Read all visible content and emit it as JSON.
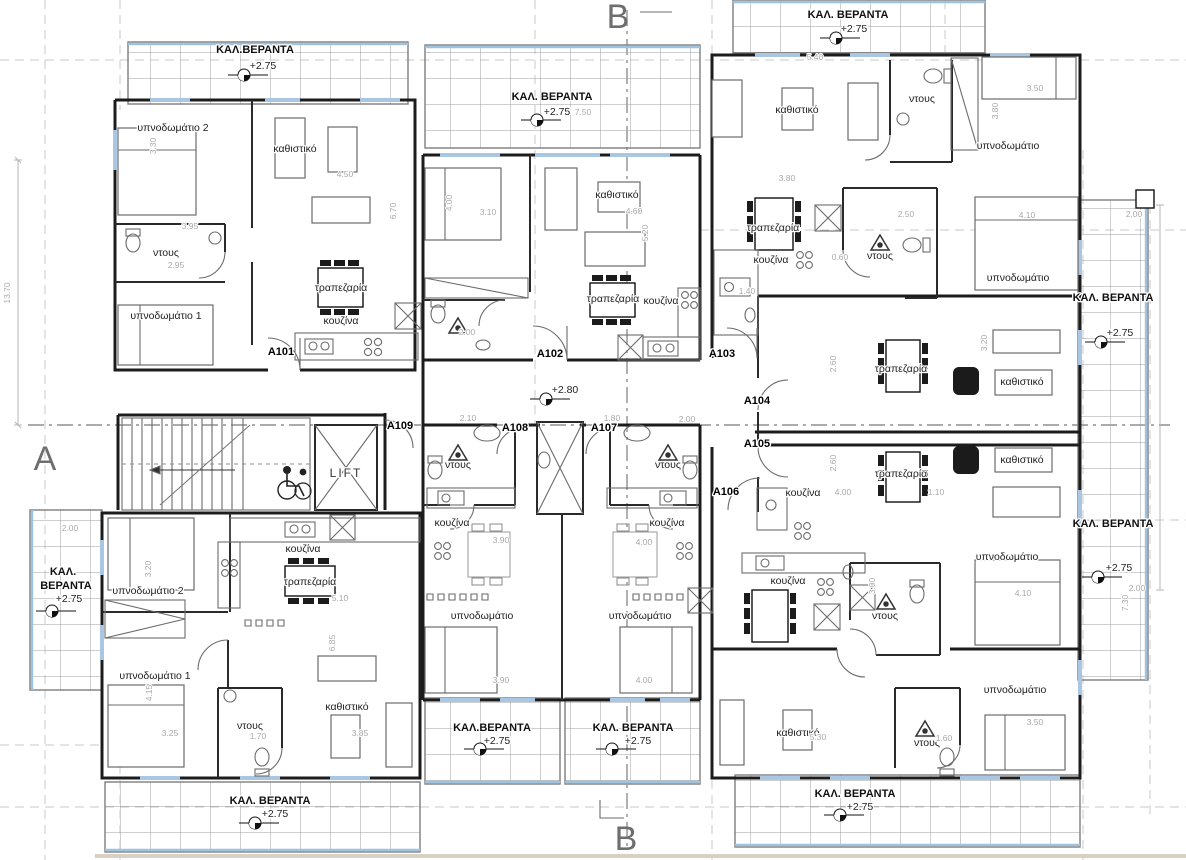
{
  "plan": {
    "title_note": "first floor apartment plan",
    "colors": {
      "wall": "#1c1c1c",
      "veranda_edge": "#9fc3df",
      "dimension": "#a9a9a9",
      "section": "#8f8f8f"
    },
    "labels": [
      {
        "n": "section-marker-b-top",
        "t": "B",
        "x": 618,
        "y": 28,
        "c": "sec"
      },
      {
        "n": "section-marker-b-bottom",
        "t": "B",
        "x": 626,
        "y": 850,
        "c": "sec"
      },
      {
        "n": "section-marker-a-left",
        "t": "A",
        "x": 45,
        "y": 470,
        "c": "sec"
      },
      {
        "n": "apartment-label",
        "t": "A101",
        "x": 281,
        "y": 355,
        "c": "apt"
      },
      {
        "n": "apartment-label",
        "t": "A102",
        "x": 550,
        "y": 357,
        "c": "apt"
      },
      {
        "n": "apartment-label",
        "t": "A103",
        "x": 722,
        "y": 357,
        "c": "apt"
      },
      {
        "n": "apartment-label",
        "t": "A104",
        "x": 757,
        "y": 404,
        "c": "apt"
      },
      {
        "n": "apartment-label",
        "t": "A105",
        "x": 757,
        "y": 447,
        "c": "apt"
      },
      {
        "n": "apartment-label",
        "t": "A106",
        "x": 726,
        "y": 495,
        "c": "apt"
      },
      {
        "n": "apartment-label",
        "t": "A107",
        "x": 604,
        "y": 431,
        "c": "apt"
      },
      {
        "n": "apartment-label",
        "t": "A108",
        "x": 515,
        "y": 431,
        "c": "apt"
      },
      {
        "n": "apartment-label",
        "t": "A109",
        "x": 400,
        "y": 429,
        "c": "apt"
      },
      {
        "n": "veranda-label",
        "t": "ΚΑΛ.ΒΕΡΑΝΤΑ",
        "x": 255,
        "y": 53,
        "c": "verl"
      },
      {
        "n": "level-label",
        "t": "+2.75",
        "x": 263,
        "y": 69,
        "c": "lvl"
      },
      {
        "n": "veranda-label",
        "t": "ΚΑΛ. ΒΕΡΑΝΤΑ",
        "x": 552,
        "y": 100,
        "c": "verl"
      },
      {
        "n": "level-label",
        "t": "+2.75",
        "x": 557,
        "y": 115,
        "c": "lvl"
      },
      {
        "n": "veranda-label",
        "t": "ΚΑΛ. ΒΕΡΑΝΤΑ",
        "x": 848,
        "y": 18,
        "c": "verl"
      },
      {
        "n": "level-label",
        "t": "+2.75",
        "x": 854,
        "y": 32,
        "c": "lvl"
      },
      {
        "n": "veranda-label",
        "t": "ΚΑΛ. ΒΕΡΑΝΤΑ",
        "x": 1113,
        "y": 301,
        "c": "verl"
      },
      {
        "n": "level-label",
        "t": "+2.75",
        "x": 1120,
        "y": 336,
        "c": "lvl"
      },
      {
        "n": "veranda-label",
        "t": "ΚΑΛ. ΒΕΡΑΝΤΑ",
        "x": 1113,
        "y": 527,
        "c": "verl"
      },
      {
        "n": "level-label",
        "t": "+2.75",
        "x": 1119,
        "y": 571,
        "c": "lvl"
      },
      {
        "n": "veranda-label",
        "t": "ΚΑΛ.",
        "x": 63,
        "y": 575,
        "c": "verl"
      },
      {
        "n": "veranda-label",
        "t": "ΒΕΡΑΝΤΑ",
        "x": 66,
        "y": 589,
        "c": "verl"
      },
      {
        "n": "level-label",
        "t": "+2.75",
        "x": 69,
        "y": 602,
        "c": "lvl"
      },
      {
        "n": "veranda-label",
        "t": "ΚΑΛ.ΒΕΡΑΝΤΑ",
        "x": 492,
        "y": 731,
        "c": "verl"
      },
      {
        "n": "level-label",
        "t": "+2.75",
        "x": 497,
        "y": 744,
        "c": "lvl"
      },
      {
        "n": "veranda-label",
        "t": "ΚΑΛ. ΒΕΡΑΝΤΑ",
        "x": 633,
        "y": 731,
        "c": "verl"
      },
      {
        "n": "level-label",
        "t": "+2.75",
        "x": 638,
        "y": 744,
        "c": "lvl"
      },
      {
        "n": "veranda-label",
        "t": "ΚΑΛ. ΒΕΡΑΝΤΑ",
        "x": 270,
        "y": 804,
        "c": "verl"
      },
      {
        "n": "level-label",
        "t": "+2.75",
        "x": 275,
        "y": 817,
        "c": "lvl"
      },
      {
        "n": "veranda-label",
        "t": "ΚΑΛ. ΒΕΡΑΝΤΑ",
        "x": 855,
        "y": 797,
        "c": "verl"
      },
      {
        "n": "level-label",
        "t": "+2.75",
        "x": 860,
        "y": 810,
        "c": "lvl"
      },
      {
        "n": "level-label",
        "t": "+2.80",
        "x": 565,
        "y": 393,
        "c": "lvl"
      },
      {
        "n": "room-label",
        "t": "υπνοδωμάτιο 2",
        "x": 173,
        "y": 131,
        "c": "room"
      },
      {
        "n": "room-label",
        "t": "καθιστικό",
        "x": 295,
        "y": 152,
        "c": "room"
      },
      {
        "n": "room-label",
        "t": "ντους",
        "x": 166,
        "y": 256,
        "c": "room"
      },
      {
        "n": "room-label",
        "t": "υπνοδωμάτιο 1",
        "x": 166,
        "y": 319,
        "c": "room"
      },
      {
        "n": "room-label",
        "t": "τραπεζαρία",
        "x": 341,
        "y": 291,
        "c": "room"
      },
      {
        "n": "room-label",
        "t": "κουζίνα",
        "x": 341,
        "y": 324,
        "c": "room"
      },
      {
        "n": "room-label",
        "t": "καθιστικό",
        "x": 617,
        "y": 198,
        "c": "room"
      },
      {
        "n": "room-label",
        "t": "τραπεζαρία",
        "x": 613,
        "y": 302,
        "c": "room"
      },
      {
        "n": "room-label",
        "t": "κουζίνα",
        "x": 661,
        "y": 304,
        "c": "room"
      },
      {
        "n": "room-label",
        "t": "καθιστικό",
        "x": 797,
        "y": 113,
        "c": "room"
      },
      {
        "n": "room-label",
        "t": "ντους",
        "x": 922,
        "y": 102,
        "c": "room"
      },
      {
        "n": "room-label",
        "t": "υπνοδωμάτιο",
        "x": 1008,
        "y": 149,
        "c": "room"
      },
      {
        "n": "room-label",
        "t": "τραπεζαρία",
        "x": 773,
        "y": 231,
        "c": "room"
      },
      {
        "n": "room-label",
        "t": "κουζίνα",
        "x": 771,
        "y": 263,
        "c": "room"
      },
      {
        "n": "room-label",
        "t": "ντους",
        "x": 880,
        "y": 259,
        "c": "room"
      },
      {
        "n": "room-label",
        "t": "υπνοδωμάτιο",
        "x": 1018,
        "y": 281,
        "c": "room"
      },
      {
        "n": "room-label",
        "t": "τραπεζαρία",
        "x": 901,
        "y": 372,
        "c": "room"
      },
      {
        "n": "room-label",
        "t": "καθιστικό",
        "x": 1022,
        "y": 385,
        "c": "room"
      },
      {
        "n": "room-label",
        "t": "τραπεζαρία",
        "x": 901,
        "y": 477,
        "c": "room"
      },
      {
        "n": "room-label",
        "t": "καθιστικό",
        "x": 1022,
        "y": 463,
        "c": "room"
      },
      {
        "n": "room-label",
        "t": "κουζίνα",
        "x": 803,
        "y": 496,
        "c": "room"
      },
      {
        "n": "room-label",
        "t": "υπνοδωμάτιο",
        "x": 1007,
        "y": 560,
        "c": "room"
      },
      {
        "n": "room-label",
        "t": "κουζίνα",
        "x": 788,
        "y": 584,
        "c": "room"
      },
      {
        "n": "room-label",
        "t": "ντους",
        "x": 885,
        "y": 619,
        "c": "room"
      },
      {
        "n": "room-label",
        "t": "υπνοδωμάτιο",
        "x": 1015,
        "y": 693,
        "c": "room"
      },
      {
        "n": "room-label",
        "t": "καθιστικό",
        "x": 798,
        "y": 736,
        "c": "room"
      },
      {
        "n": "room-label",
        "t": "ντους",
        "x": 927,
        "y": 746,
        "c": "room"
      },
      {
        "n": "lift-label",
        "t": "LIFT",
        "x": 346,
        "y": 477,
        "c": "lift"
      },
      {
        "n": "room-label",
        "t": "ντους",
        "x": 458,
        "y": 468,
        "c": "room"
      },
      {
        "n": "room-label",
        "t": "κουζίνα",
        "x": 452,
        "y": 526,
        "c": "room"
      },
      {
        "n": "room-label",
        "t": "κουζίνα",
        "x": 667,
        "y": 526,
        "c": "room"
      },
      {
        "n": "room-label",
        "t": "ντους",
        "x": 668,
        "y": 468,
        "c": "room"
      },
      {
        "n": "room-label",
        "t": "υπνοδωμάτιο",
        "x": 482,
        "y": 619,
        "c": "room"
      },
      {
        "n": "room-label",
        "t": "υπνοδωμάτιο",
        "x": 640,
        "y": 619,
        "c": "room"
      },
      {
        "n": "room-label",
        "t": "κουζίνα",
        "x": 303,
        "y": 552,
        "c": "room"
      },
      {
        "n": "room-label",
        "t": "τραπεζαρία",
        "x": 310,
        "y": 585,
        "c": "room"
      },
      {
        "n": "room-label",
        "t": "υπνοδωμάτιο 2",
        "x": 148,
        "y": 594,
        "c": "room"
      },
      {
        "n": "room-label",
        "t": "υπνοδωμάτιο 1",
        "x": 155,
        "y": 679,
        "c": "room"
      },
      {
        "n": "room-label",
        "t": "ντους",
        "x": 250,
        "y": 729,
        "c": "room"
      },
      {
        "n": "room-label",
        "t": "καθιστικό",
        "x": 347,
        "y": 710,
        "c": "room"
      },
      {
        "n": "dimension-label",
        "t": "3.95",
        "x": 190,
        "y": 229,
        "c": "dim"
      },
      {
        "n": "dimension-label",
        "t": "2.95",
        "x": 176,
        "y": 268,
        "c": "dim"
      },
      {
        "n": "dimension-label",
        "t": "3.30",
        "x": 156,
        "y": 146,
        "c": "dim",
        "r": -90
      },
      {
        "n": "dimension-label",
        "t": "4.50",
        "x": 345,
        "y": 177,
        "c": "dim"
      },
      {
        "n": "dimension-label",
        "t": "6.70",
        "x": 396,
        "y": 211,
        "c": "dim",
        "r": -90
      },
      {
        "n": "dimension-label",
        "t": "4.00",
        "x": 452,
        "y": 203,
        "c": "dim",
        "r": -90
      },
      {
        "n": "dimension-label",
        "t": "3.10",
        "x": 488,
        "y": 215,
        "c": "dim"
      },
      {
        "n": "dimension-label",
        "t": "4.60",
        "x": 634,
        "y": 214,
        "c": "dim"
      },
      {
        "n": "dimension-label",
        "t": "5.20",
        "x": 648,
        "y": 233,
        "c": "dim",
        "r": -90
      },
      {
        "n": "dimension-label",
        "t": "7.50",
        "x": 583,
        "y": 115,
        "c": "dim"
      },
      {
        "n": "dimension-label",
        "t": "2.00",
        "x": 467,
        "y": 335,
        "c": "dim"
      },
      {
        "n": "dimension-label",
        "t": "5.40",
        "x": 815,
        "y": 60,
        "c": "dim"
      },
      {
        "n": "dimension-label",
        "t": "3.80",
        "x": 787,
        "y": 181,
        "c": "dim"
      },
      {
        "n": "dimension-label",
        "t": "3.50",
        "x": 1035,
        "y": 91,
        "c": "dim"
      },
      {
        "n": "dimension-label",
        "t": "3.80",
        "x": 998,
        "y": 111,
        "c": "dim",
        "r": -90
      },
      {
        "n": "dimension-label",
        "t": "2.50",
        "x": 906,
        "y": 217,
        "c": "dim"
      },
      {
        "n": "dimension-label",
        "t": "4.10",
        "x": 1027,
        "y": 218,
        "c": "dim"
      },
      {
        "n": "dimension-label",
        "t": "2.10",
        "x": 468,
        "y": 421,
        "c": "dim"
      },
      {
        "n": "dimension-label",
        "t": "1.80",
        "x": 612,
        "y": 421,
        "c": "dim"
      },
      {
        "n": "dimension-label",
        "t": "2.00",
        "x": 687,
        "y": 422,
        "c": "dim"
      },
      {
        "n": "dimension-label",
        "t": "2.60",
        "x": 836,
        "y": 364,
        "c": "dim",
        "r": -90
      },
      {
        "n": "dimension-label",
        "t": "2.60",
        "x": 836,
        "y": 463,
        "c": "dim",
        "r": -90
      },
      {
        "n": "dimension-label",
        "t": "4.00",
        "x": 843,
        "y": 495,
        "c": "dim"
      },
      {
        "n": "dimension-label",
        "t": "1.10",
        "x": 936,
        "y": 495,
        "c": "dim"
      },
      {
        "n": "dimension-label",
        "t": "3.20",
        "x": 987,
        "y": 343,
        "c": "dim",
        "r": -90
      },
      {
        "n": "dimension-label",
        "t": "3.90",
        "x": 501,
        "y": 543,
        "c": "dim"
      },
      {
        "n": "dimension-label",
        "t": "4.00",
        "x": 644,
        "y": 545,
        "c": "dim"
      },
      {
        "n": "dimension-label",
        "t": "3.90",
        "x": 501,
        "y": 683,
        "c": "dim"
      },
      {
        "n": "dimension-label",
        "t": "4.00",
        "x": 644,
        "y": 683,
        "c": "dim"
      },
      {
        "n": "dimension-label",
        "t": "2.00",
        "x": 70,
        "y": 531,
        "c": "dim"
      },
      {
        "n": "dimension-label",
        "t": "3.20",
        "x": 151,
        "y": 569,
        "c": "dim",
        "r": -90
      },
      {
        "n": "dimension-label",
        "t": "4.15",
        "x": 152,
        "y": 693,
        "c": "dim",
        "r": -90
      },
      {
        "n": "dimension-label",
        "t": "3.25",
        "x": 170,
        "y": 736,
        "c": "dim"
      },
      {
        "n": "dimension-label",
        "t": "1.70",
        "x": 258,
        "y": 739,
        "c": "dim"
      },
      {
        "n": "dimension-label",
        "t": "3.85",
        "x": 360,
        "y": 736,
        "c": "dim"
      },
      {
        "n": "dimension-label",
        "t": "6.85",
        "x": 335,
        "y": 643,
        "c": "dim",
        "r": -90
      },
      {
        "n": "dimension-label",
        "t": "5.10",
        "x": 340,
        "y": 601,
        "c": "dim"
      },
      {
        "n": "dimension-label",
        "t": "1.40",
        "x": 747,
        "y": 294,
        "c": "dim"
      },
      {
        "n": "dimension-label",
        "t": "0.60",
        "x": 840,
        "y": 260,
        "c": "dim"
      },
      {
        "n": "dimension-label",
        "t": "3.00",
        "x": 875,
        "y": 586,
        "c": "dim",
        "r": -90
      },
      {
        "n": "dimension-label",
        "t": "4.10",
        "x": 1023,
        "y": 596,
        "c": "dim"
      },
      {
        "n": "dimension-label",
        "t": "3.50",
        "x": 1035,
        "y": 725,
        "c": "dim"
      },
      {
        "n": "dimension-label",
        "t": "1.60",
        "x": 944,
        "y": 741,
        "c": "dim"
      },
      {
        "n": "dimension-label",
        "t": "5.30",
        "x": 818,
        "y": 740,
        "c": "dim"
      },
      {
        "n": "dimension-label",
        "t": "7.30",
        "x": 1128,
        "y": 603,
        "c": "dim",
        "r": -90
      },
      {
        "n": "dimension-label",
        "t": "2.00",
        "x": 1134,
        "y": 217,
        "c": "dim"
      },
      {
        "n": "dimension-label",
        "t": "2.00",
        "x": 1137,
        "y": 591,
        "c": "dim"
      },
      {
        "n": "dimension-label",
        "t": "13.70",
        "x": 10,
        "y": 293,
        "c": "dim",
        "r": -90
      }
    ],
    "level_markers": [
      {
        "x": 244,
        "y": 75
      },
      {
        "x": 537,
        "y": 120
      },
      {
        "x": 836,
        "y": 38
      },
      {
        "x": 1101,
        "y": 342
      },
      {
        "x": 1098,
        "y": 577
      },
      {
        "x": 52,
        "y": 611
      },
      {
        "x": 480,
        "y": 749
      },
      {
        "x": 612,
        "y": 749
      },
      {
        "x": 255,
        "y": 823
      },
      {
        "x": 840,
        "y": 815
      },
      {
        "x": 546,
        "y": 399
      }
    ]
  }
}
